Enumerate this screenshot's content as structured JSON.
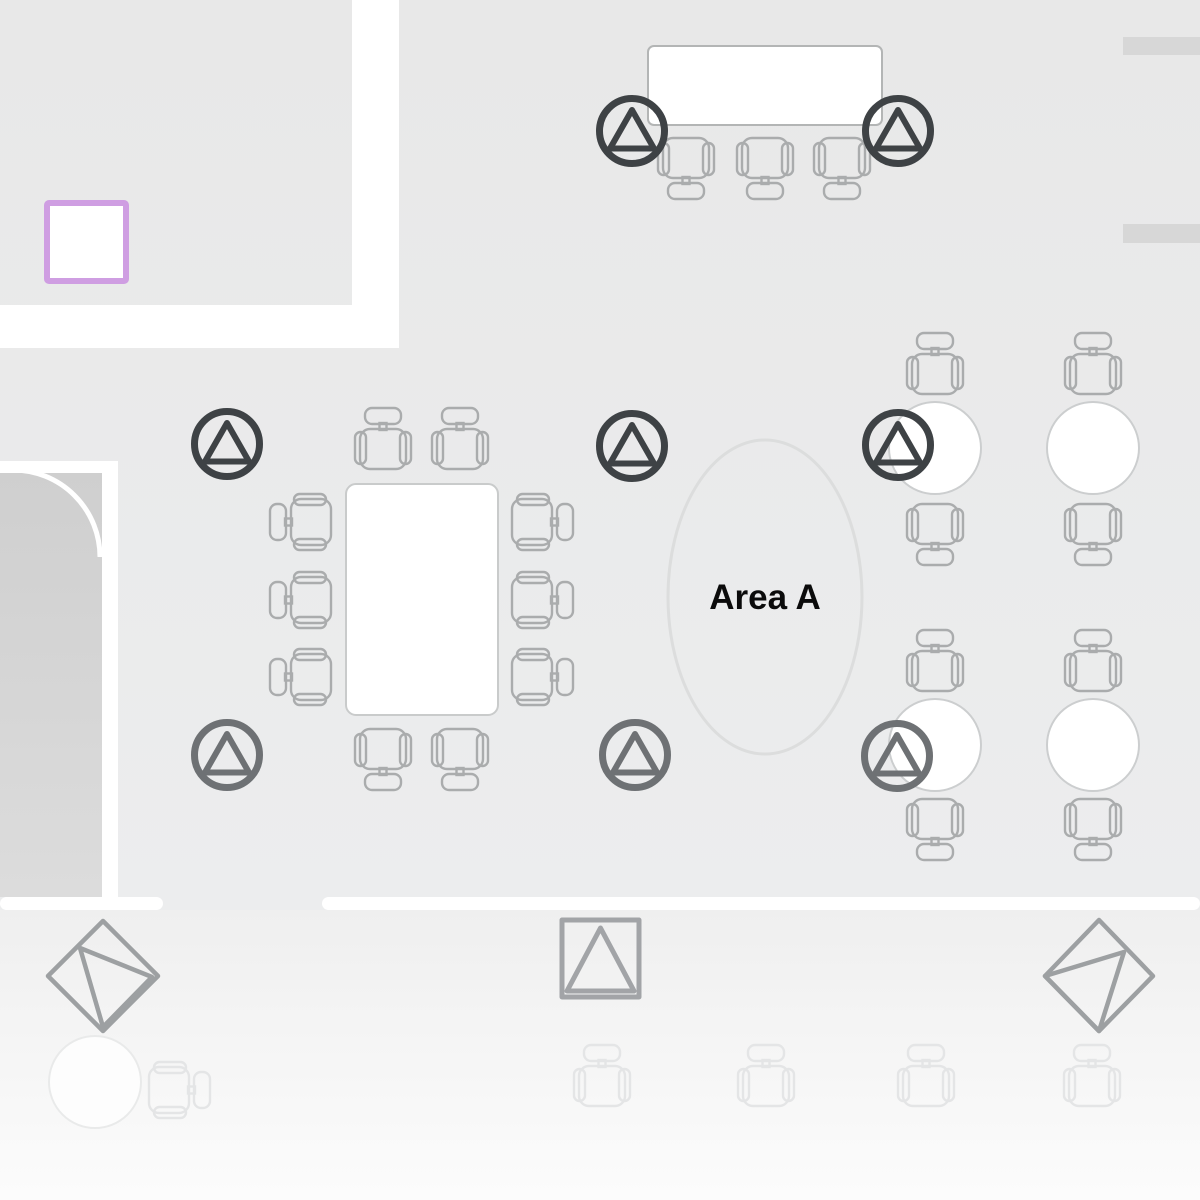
{
  "meta": {
    "title": "Floor plan seating layout"
  },
  "area": {
    "label": "Area A",
    "label_x": "765",
    "label_y": "609",
    "ellipse": {
      "cx": 765,
      "cy": 597,
      "rx": 97,
      "ry": 157
    }
  },
  "palette": {
    "floor_top": "#e8e8e8",
    "floor_bottom": "#ecedee",
    "lower_top": "#efefef",
    "lower_bottom": "#fcfcfc",
    "corridor_top": "#cfcfcf",
    "corridor_bottom": "#dcdcdc",
    "wall_white": "#ffffff",
    "wall_segment": "#d7d7d7",
    "chair": "#aaacad",
    "chair_faded": "#e4e5e6",
    "table_fill": "#ffffff",
    "table_stroke": "#c9cbcb",
    "top_table_stroke": "#b3b5b5",
    "round_table_stroke": "#cccecf",
    "faded_table_fill": "#fdfdfd",
    "faded_table_stroke": "#e9eaea",
    "marker_dark": "#3e4245",
    "marker_mid": "#6e7174",
    "symbol": "#9da0a2",
    "square_symbol": "#a2a4a7",
    "highlight": "#cf9ee2",
    "ellipse_stroke": "#dcdddd",
    "label_color": "#0b0b0b"
  },
  "floor": {
    "base": {
      "x": 0,
      "y": 0,
      "w": 1200,
      "h": 911
    },
    "lower": {
      "x": 0,
      "y": 910,
      "w": 1200,
      "h": 290
    },
    "corridor": {
      "x": 0,
      "y": 473,
      "w": 102,
      "h": 424
    }
  },
  "walls_white": [
    {
      "x": 352,
      "y": 0,
      "w": 47,
      "h": 348,
      "rx": 0
    },
    {
      "x": 0,
      "y": 305,
      "w": 399,
      "h": 43,
      "rx": 0
    },
    {
      "x": 0,
      "y": 461,
      "w": 118,
      "h": 12,
      "rx": 0
    },
    {
      "x": 102,
      "y": 461,
      "w": 16,
      "h": 444,
      "rx": 0
    },
    {
      "x": 0,
      "y": 897,
      "w": 163,
      "h": 13,
      "rx": 6.5
    },
    {
      "x": 322,
      "y": 897,
      "w": 878,
      "h": 13,
      "rx": 6.5
    }
  ],
  "wall_segments": [
    {
      "x": 1123,
      "y": 37,
      "w": 77,
      "h": 18
    },
    {
      "x": 1123,
      "y": 224,
      "w": 77,
      "h": 19
    }
  ],
  "door_arc": {
    "d": "M 100 557 A 87 87 0 0 0 13 470",
    "width": 5
  },
  "highlight_square": {
    "x": 47,
    "y": 203,
    "w": 79,
    "h": 78,
    "stroke_width": 6
  },
  "tables": {
    "rect": [
      {
        "x": 648,
        "y": 46,
        "w": 234,
        "h": 79,
        "rx": 6,
        "stroke": "top_table_stroke"
      },
      {
        "x": 346,
        "y": 484,
        "w": 152,
        "h": 231,
        "rx": 10,
        "stroke": "table_stroke"
      }
    ],
    "round": [
      {
        "cx": 935,
        "cy": 448,
        "r": 46
      },
      {
        "cx": 1093,
        "cy": 448,
        "r": 46
      },
      {
        "cx": 935,
        "cy": 745,
        "r": 46
      },
      {
        "cx": 1093,
        "cy": 745,
        "r": 46
      }
    ],
    "faded_round": [
      {
        "cx": 95,
        "cy": 1082,
        "r": 46
      }
    ]
  },
  "chairs": {
    "normal": [
      [
        686,
        166,
        180
      ],
      [
        765,
        166,
        180
      ],
      [
        842,
        166,
        180
      ],
      [
        383,
        441,
        0
      ],
      [
        460,
        441,
        0
      ],
      [
        383,
        757,
        180
      ],
      [
        460,
        757,
        180
      ],
      [
        303,
        522,
        -90
      ],
      [
        303,
        600,
        -90
      ],
      [
        303,
        677,
        -90
      ],
      [
        540,
        522,
        90
      ],
      [
        540,
        600,
        90
      ],
      [
        540,
        677,
        90
      ],
      [
        935,
        366,
        0
      ],
      [
        1093,
        366,
        0
      ],
      [
        935,
        532,
        180
      ],
      [
        1093,
        532,
        180
      ],
      [
        935,
        663,
        0
      ],
      [
        1093,
        663,
        0
      ],
      [
        935,
        827,
        180
      ],
      [
        1093,
        827,
        180
      ]
    ],
    "faded": [
      [
        602,
        1078,
        0
      ],
      [
        766,
        1078,
        0
      ],
      [
        926,
        1078,
        0
      ],
      [
        1092,
        1078,
        0
      ],
      [
        177,
        1090,
        90
      ]
    ]
  },
  "markers": [
    {
      "x": 632,
      "y": 131,
      "tone": "dark"
    },
    {
      "x": 898,
      "y": 131,
      "tone": "dark"
    },
    {
      "x": 227,
      "y": 444,
      "tone": "dark"
    },
    {
      "x": 632,
      "y": 446,
      "tone": "dark"
    },
    {
      "x": 898,
      "y": 445,
      "tone": "dark"
    },
    {
      "x": 227,
      "y": 755,
      "tone": "mid"
    },
    {
      "x": 635,
      "y": 755,
      "tone": "mid"
    },
    {
      "x": 897,
      "y": 756,
      "tone": "mid"
    }
  ],
  "symbols": {
    "diamonds": [
      {
        "outline": "M103 921 L158 976 L103 1031 L48 976 Z",
        "triangle": "M80 948 L152 977 L103 1027 Z"
      },
      {
        "outline": "M1099 920 L1153 976 L1099 1031 L1045 976 Z",
        "triangle": "M1124 952 L1045 976 L1099 1031 Z"
      }
    ],
    "square_triangle": {
      "square": "M562 920 H639 V997 H562 Z",
      "triangle": "M600.5 928 L634 991 L567 991 Z",
      "width": 5
    }
  }
}
